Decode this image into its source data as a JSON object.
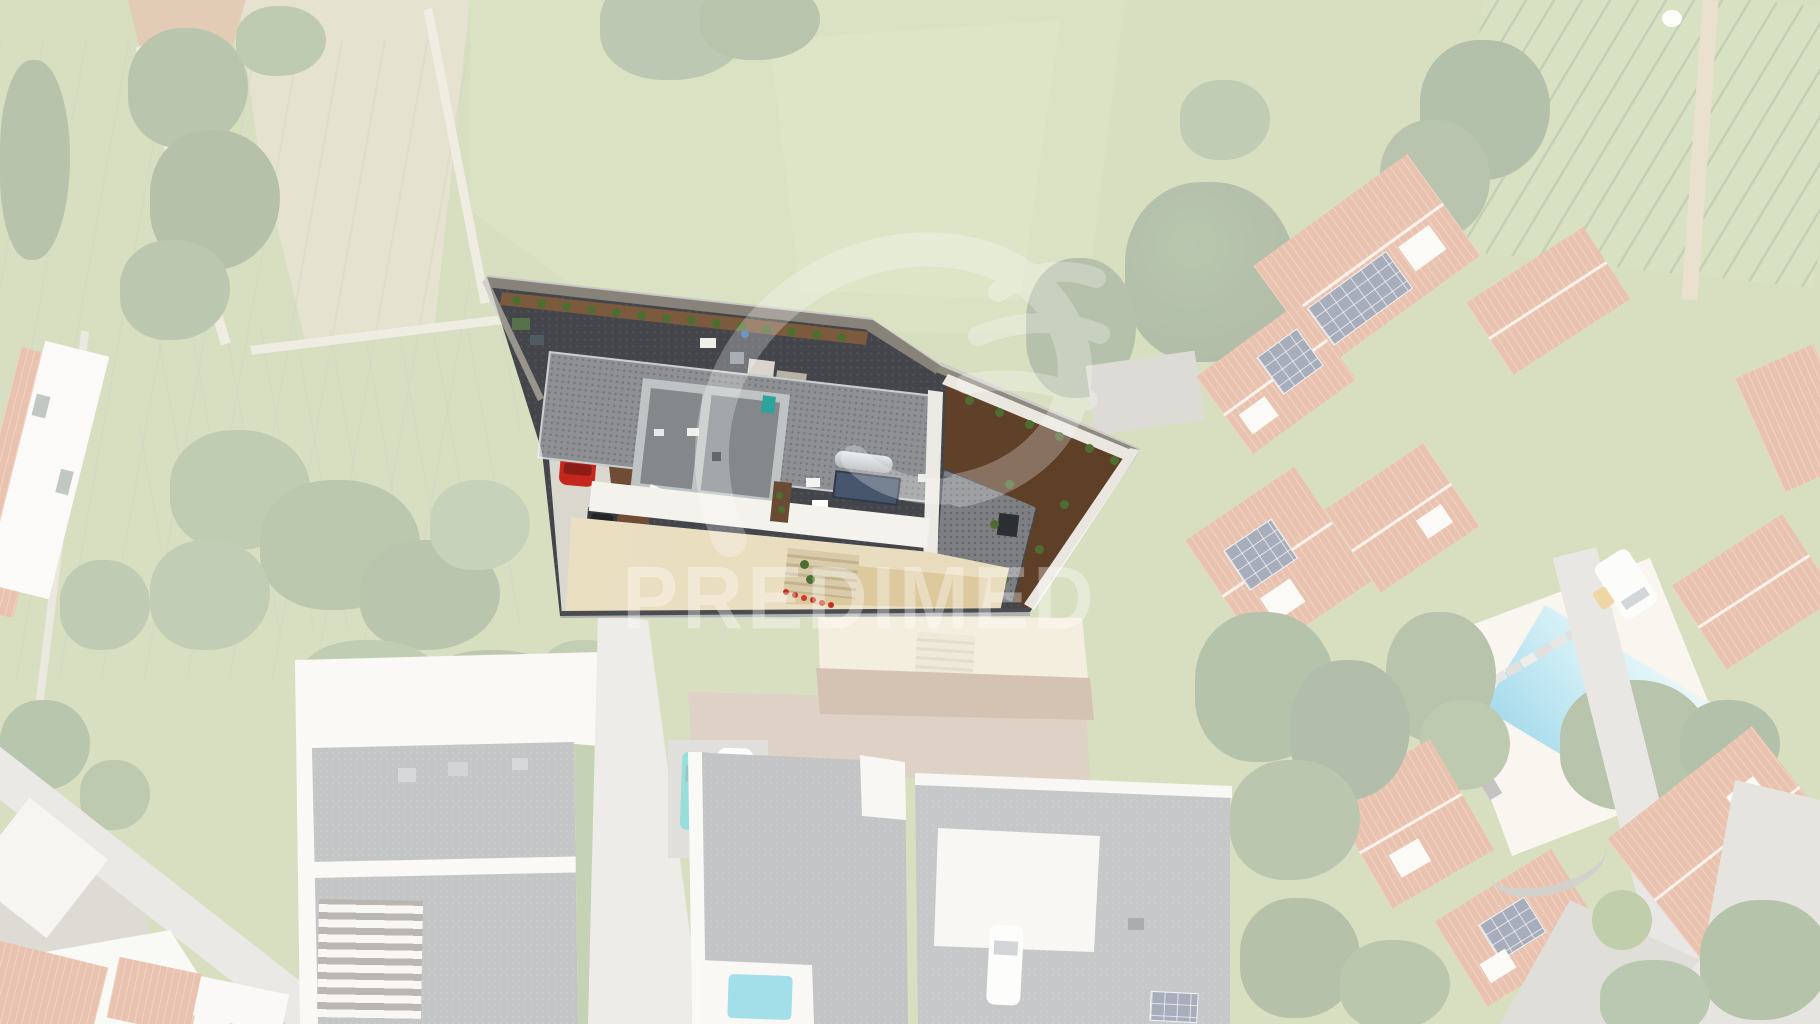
{
  "watermark": {
    "text": "PREDIMED",
    "color": "#ffffff",
    "opacity": "0.34",
    "logo": "predimed-flourish-logo"
  },
  "scene": {
    "type": "aerial-drone-photo",
    "highlight": "central-villa-property",
    "palette": {
      "grass": "#a4b671",
      "dry_field": "#c3bd8f",
      "tree_green": "#55703c",
      "roof_orange": "#cd7449",
      "solar_panel": "#33415f",
      "road": "#d6d2c8",
      "pool_water": "#2fa9d2",
      "pool_deck": "#efe9d8",
      "villa_roof_gravel": "#8e9093",
      "villa_dark_gravel": "#43454a",
      "villa_dirt_brown": "#5e4029",
      "villa_patio_beige": "#e9ddc1",
      "terrace_white": "#f2f1ea",
      "red_car": "#c5271d",
      "teal_car": "#17b3ae",
      "white_car": "#fbfaf6",
      "fade_veil": "rgba(255,255,255,0.57)"
    }
  }
}
